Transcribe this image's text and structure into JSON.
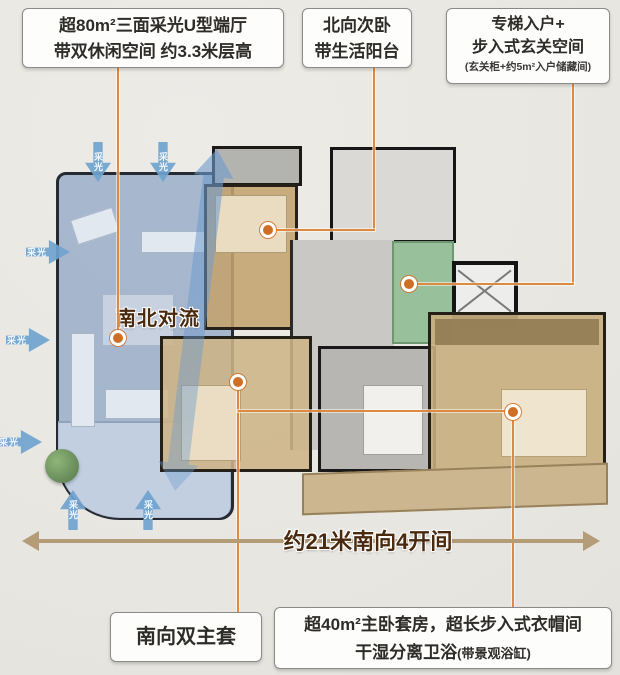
{
  "callouts": {
    "living_hall": {
      "line1": "超80m²三面采光U型端厅",
      "line2": "带双休闲空间 约3.3米层高"
    },
    "north_bedroom": {
      "line1": "北向次卧",
      "line2": "带生活阳台"
    },
    "entry": {
      "line1": "专梯入户+",
      "line2": "步入式玄关空间",
      "note": "(玄关柜+约5m²入户储藏间)"
    },
    "double_master": {
      "label": "南向双主套"
    },
    "master_suite": {
      "line1": "超40m²主卧套房，超长步入式衣帽间",
      "line2": "干湿分离卫浴",
      "note": "(带景观浴缸)"
    }
  },
  "plan_labels": {
    "convection": "南北对流",
    "daylight": "采光",
    "dimension": "约21米南向4开间"
  },
  "colors": {
    "background": "#e9e7e2",
    "leader_line": "#dc8a40",
    "marker_dot": "#cf6f26",
    "dimension_line": "#b49c78",
    "outlined_text": "#4a2a0e",
    "blue_zone": "#96acc8",
    "tan_zone": "#c4a370",
    "green_zone": "#8fbc95",
    "daylight_arrow": "#6fa3cf"
  }
}
